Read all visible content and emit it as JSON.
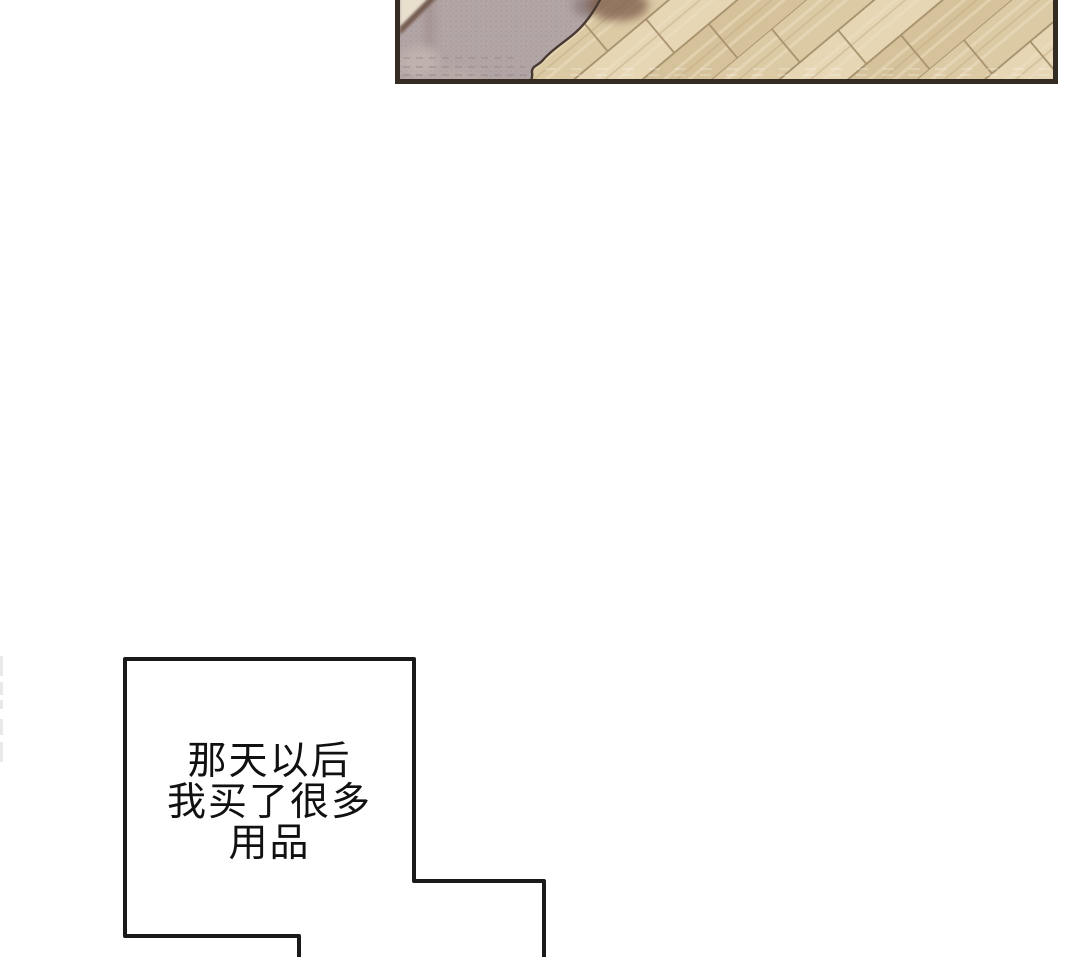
{
  "page": {
    "kind": "webtoon-comic-page",
    "background_color": "#ffffff",
    "width": 1080,
    "height": 957
  },
  "top_panel": {
    "description": "cropped panel: mauve rug corner on diagonal wooden plank floor",
    "border_color": "#342b23",
    "floor": {
      "plank_base_color": "#dccaa5",
      "plank_light_color": "#e6d6b4",
      "plank_dark_color": "#d5c29b",
      "plank_line_color": "#a7906c",
      "plank_angle_deg": 40
    },
    "rug": {
      "base_color": "#b2a5a5",
      "dot_texture_color": "#8f7f83",
      "contour_color": "#473931",
      "corner_cream_color": "#e9dfcd",
      "corner_band_color": "#70564a",
      "shadow_color": "#7a5a48"
    }
  },
  "caption": {
    "lines": [
      "那天以后",
      "我买了很多",
      "用品"
    ],
    "text_color": "#111111",
    "border_color": "#1a1a1a",
    "fill_color": "#ffffff"
  },
  "page_edge_marks": {
    "color": "#e7e7e7",
    "description": "faint broken sketch line at left page edge"
  }
}
